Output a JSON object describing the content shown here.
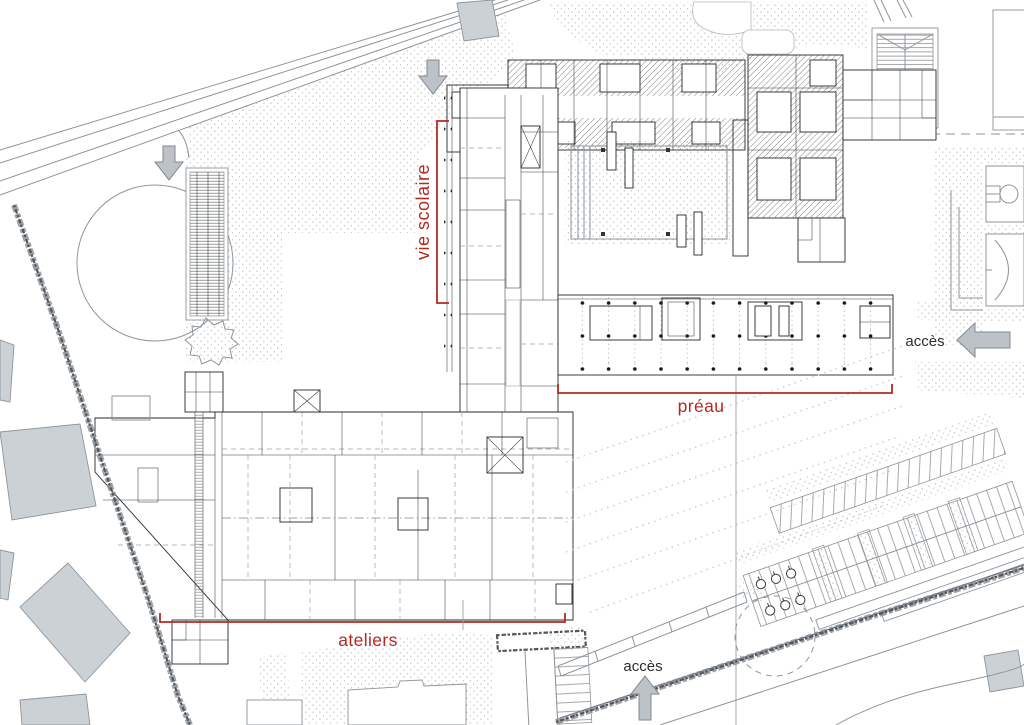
{
  "plan": {
    "type": "architectural site plan (school campus, ground floor)",
    "labels": {
      "vie_scolaire": "vie scolaire",
      "preau": "préau",
      "ateliers": "ateliers",
      "acces_east": "accès",
      "acces_south": "accès"
    },
    "icons": [
      "down-arrow-icon",
      "down-arrow-icon",
      "left-arrow-icon",
      "up-arrow-icon"
    ],
    "colors": {
      "annotation_red": "#b22a22",
      "label_dark": "#2e2e2e",
      "arrow_fill": "#bcc2c8",
      "arrow_stroke": "#82888e",
      "context_gray": "#ccd1d6",
      "line_dark": "#26282a"
    }
  }
}
